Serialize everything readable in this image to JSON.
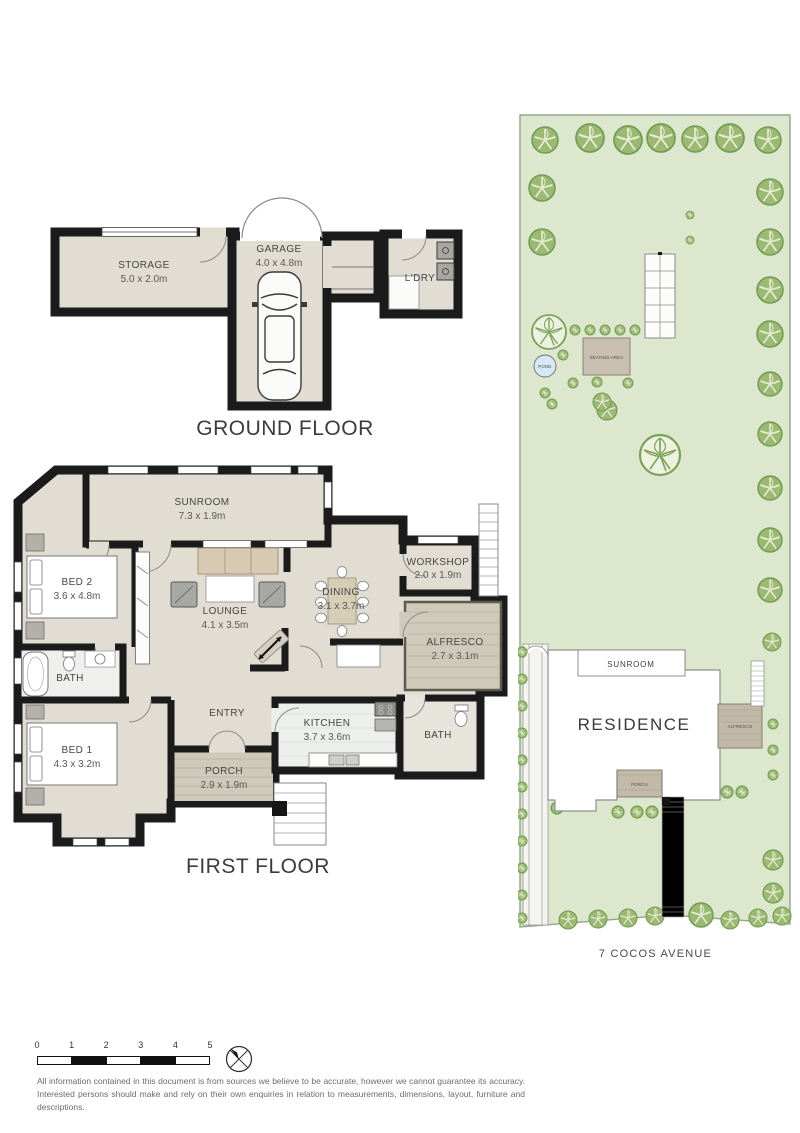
{
  "ground_floor": {
    "title": "GROUND FLOOR",
    "rooms": [
      {
        "name": "STORAGE",
        "dims": "5.0 x 2.0m"
      },
      {
        "name": "GARAGE",
        "dims": "4.0 x 4.8m"
      },
      {
        "name": "L'DRY",
        "dims": ""
      }
    ]
  },
  "first_floor": {
    "title": "FIRST FLOOR",
    "rooms": [
      {
        "name": "SUNROOM",
        "dims": "7.3 x 1.9m"
      },
      {
        "name": "BED 2",
        "dims": "3.6 x 4.8m"
      },
      {
        "name": "LOUNGE",
        "dims": "4.1 x 3.5m"
      },
      {
        "name": "DINING",
        "dims": "3.1 x 3.7m"
      },
      {
        "name": "WORKSHOP",
        "dims": "2.0 x 1.9m"
      },
      {
        "name": "ALFRESCO",
        "dims": "2.7 x 3.1m"
      },
      {
        "name": "BATH",
        "dims": ""
      },
      {
        "name": "BED 1",
        "dims": "4.3 x 3.2m"
      },
      {
        "name": "ENTRY",
        "dims": ""
      },
      {
        "name": "PORCH",
        "dims": "2.9 x 1.9m"
      },
      {
        "name": "KITCHEN",
        "dims": "3.7 x 3.6m"
      },
      {
        "name": "BATH",
        "dims": ""
      }
    ]
  },
  "site_plan": {
    "address": "7 COCOS AVENUE",
    "labels": {
      "residence": "RESIDENCE",
      "sunroom": "SUNROOM",
      "alfresco": "ALFRESCO",
      "porch": "PORCH",
      "seating_area": "SEATING AREA",
      "pond": "POND"
    },
    "trees": [
      [
        27,
        28,
        13
      ],
      [
        72,
        26,
        14
      ],
      [
        110,
        28,
        14
      ],
      [
        143,
        26,
        14
      ],
      [
        177,
        27,
        13
      ],
      [
        212,
        26,
        14
      ],
      [
        250,
        28,
        13
      ],
      [
        24,
        76,
        13
      ],
      [
        24,
        130,
        13
      ],
      [
        252,
        80,
        13
      ],
      [
        252,
        130,
        13
      ],
      [
        252,
        178,
        13
      ],
      [
        252,
        222,
        13
      ],
      [
        252,
        272,
        12
      ],
      [
        252,
        322,
        12
      ],
      [
        252,
        376,
        12
      ],
      [
        252,
        428,
        12
      ],
      [
        252,
        478,
        12
      ],
      [
        254,
        530,
        9
      ],
      [
        89,
        298,
        10
      ],
      [
        84,
        290,
        9
      ],
      [
        255,
        748,
        10
      ],
      [
        255,
        781,
        10
      ],
      [
        50,
        808,
        9
      ],
      [
        80,
        807,
        9
      ],
      [
        110,
        806,
        9
      ],
      [
        137,
        804,
        9
      ],
      [
        183,
        803,
        12
      ],
      [
        212,
        808,
        9
      ],
      [
        240,
        806,
        9
      ],
      [
        264,
        804,
        9
      ]
    ],
    "big_trees": [
      [
        31,
        220,
        17
      ],
      [
        142,
        343,
        20
      ]
    ],
    "bushes": [
      [
        57,
        218,
        5
      ],
      [
        72,
        218,
        5
      ],
      [
        87,
        218,
        5
      ],
      [
        102,
        218,
        5
      ],
      [
        117,
        218,
        5
      ],
      [
        45,
        243,
        5
      ],
      [
        55,
        271,
        5
      ],
      [
        27,
        281,
        5
      ],
      [
        79,
        270,
        5
      ],
      [
        110,
        271,
        5
      ],
      [
        34,
        292,
        5
      ],
      [
        172,
        103,
        4
      ],
      [
        172,
        128,
        4
      ],
      [
        39,
        696,
        6
      ],
      [
        100,
        700,
        6
      ],
      [
        119,
        700,
        6
      ],
      [
        134,
        700,
        6
      ],
      [
        177,
        680,
        6
      ],
      [
        194,
        680,
        6
      ],
      [
        209,
        680,
        6
      ],
      [
        224,
        680,
        6
      ],
      [
        255,
        612,
        5
      ],
      [
        255,
        638,
        5
      ],
      [
        255,
        663,
        5
      ],
      [
        4,
        540,
        5
      ],
      [
        4,
        567,
        5
      ],
      [
        4,
        594,
        5
      ],
      [
        4,
        621,
        5
      ],
      [
        4,
        648,
        5
      ],
      [
        4,
        675,
        5
      ],
      [
        4,
        702,
        5
      ],
      [
        4,
        729,
        5
      ],
      [
        4,
        756,
        5
      ],
      [
        4,
        783,
        5
      ],
      [
        4,
        806,
        5
      ]
    ]
  },
  "scale_bar": {
    "ticks": [
      "0",
      "1",
      "2",
      "3",
      "4",
      "5"
    ]
  },
  "disclaimer": "All information contained in this document is from sources we believe to be accurate, however we cannot guarantee its accuracy. Interested persons should make and rely on their own enquiries in relation to measurements, dimensions, layout, furniture and descriptions.",
  "colors": {
    "floor": "#e1ddd3",
    "wall": "#1b1b1b",
    "deck": "#cfc9ba",
    "site_green": "#dde7ce",
    "tree_green": "#7aa258",
    "pond_blue": "#d6e7f6",
    "seating": "#c9bfb1",
    "site_deck": "#c3b9a9"
  }
}
